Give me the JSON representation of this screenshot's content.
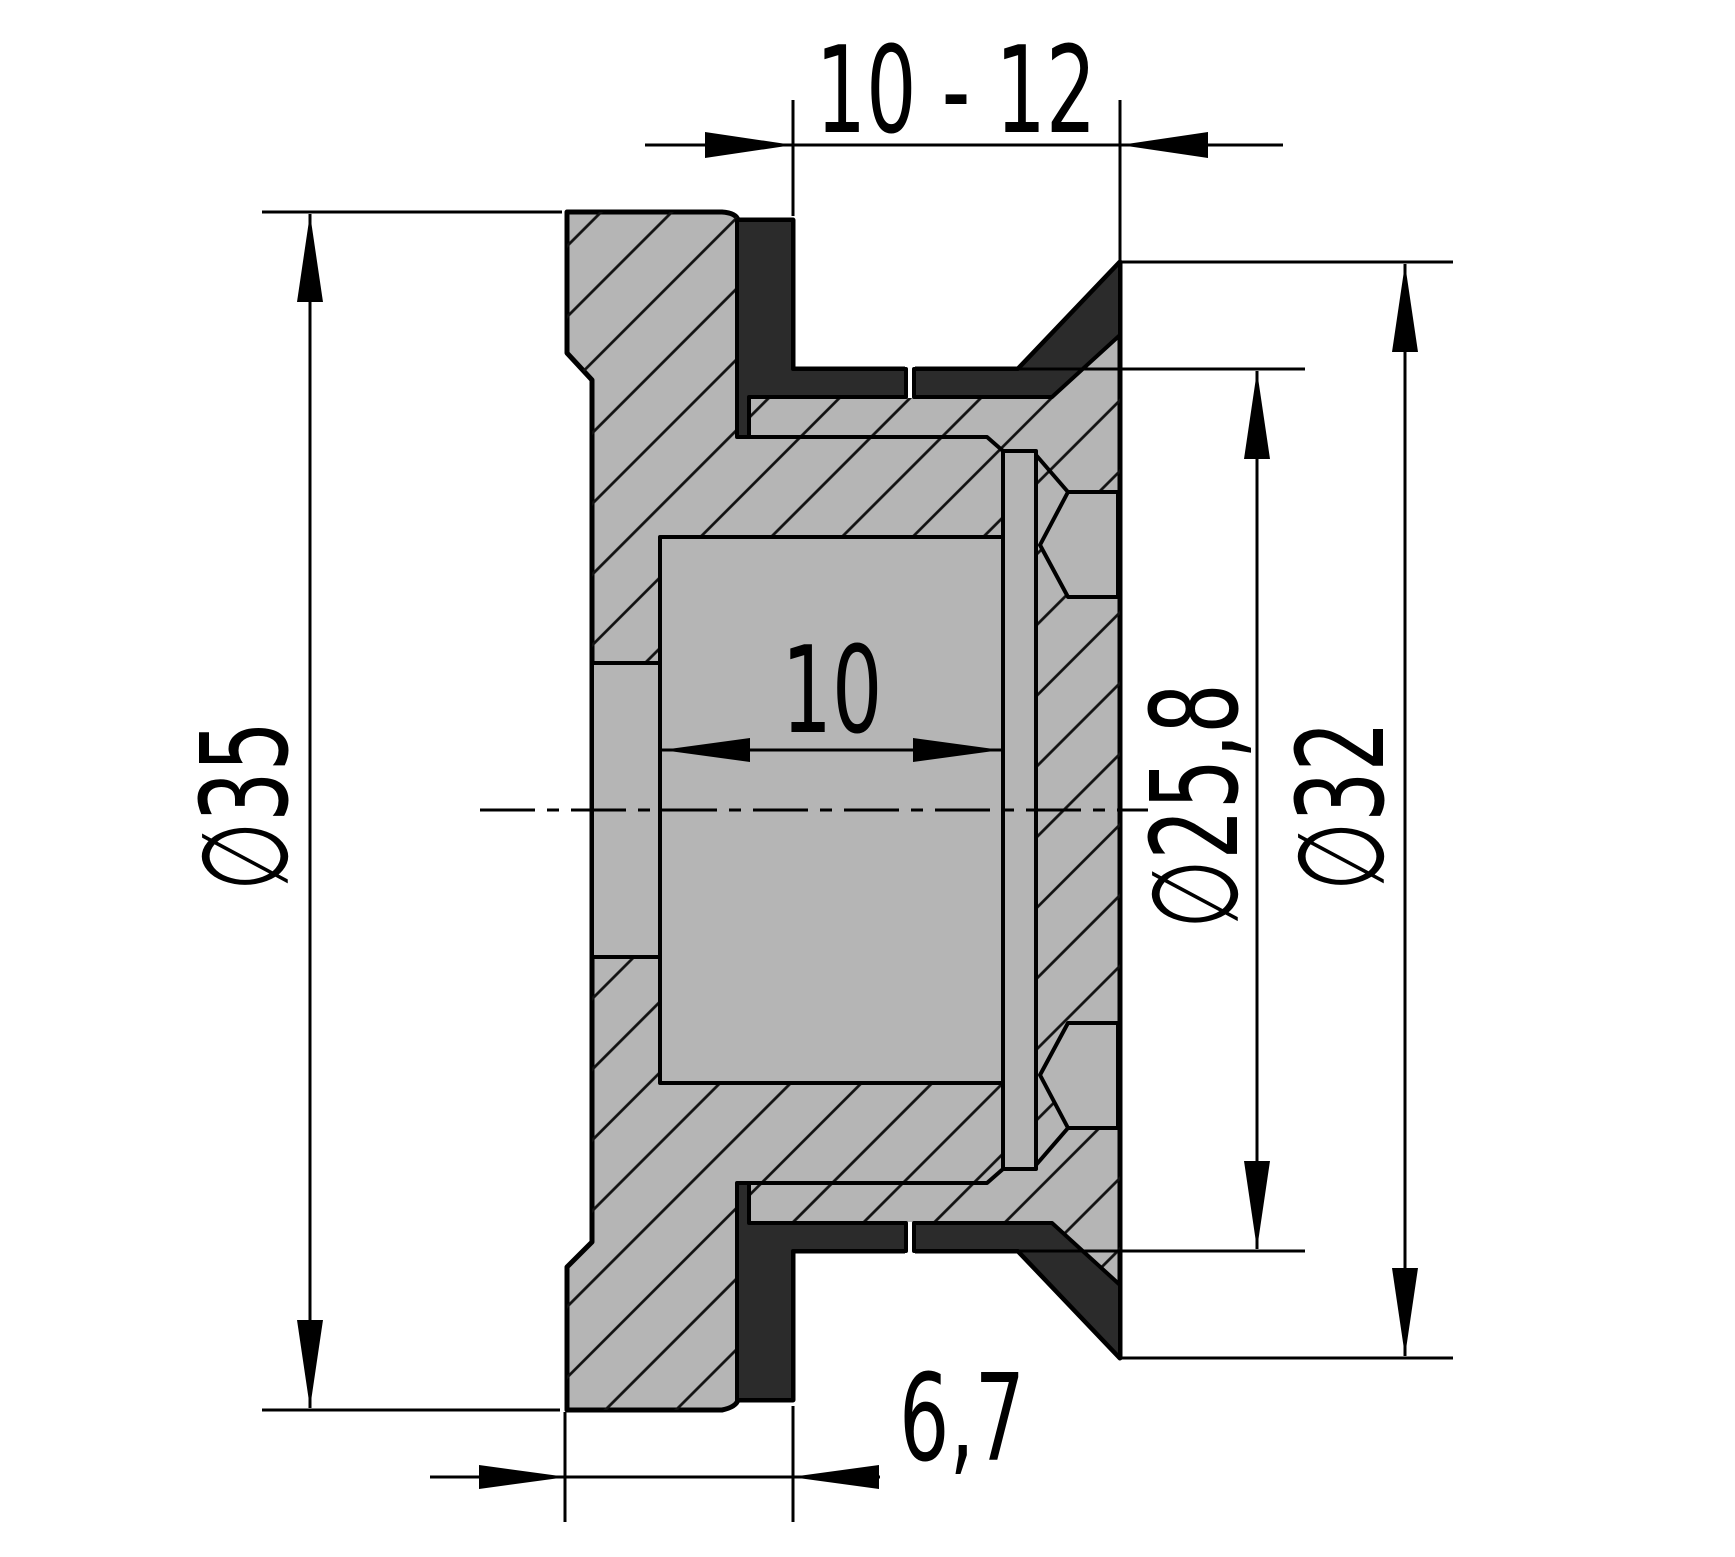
{
  "drawing": {
    "type": "technical-section-drawing",
    "part": "panel-grommet-cross-section",
    "colors": {
      "background": "#ffffff",
      "body": "#b5b5b5",
      "rubber_seal": "#2b2b2b",
      "line": "#000000"
    },
    "dimensions": {
      "panel_thickness_range": "10 - 12",
      "flange_diameter": "∅35",
      "bore_length": "10",
      "flange_stack_height": "6,7",
      "neck_diameter": "∅25,8",
      "cone_diameter": "∅32"
    }
  }
}
